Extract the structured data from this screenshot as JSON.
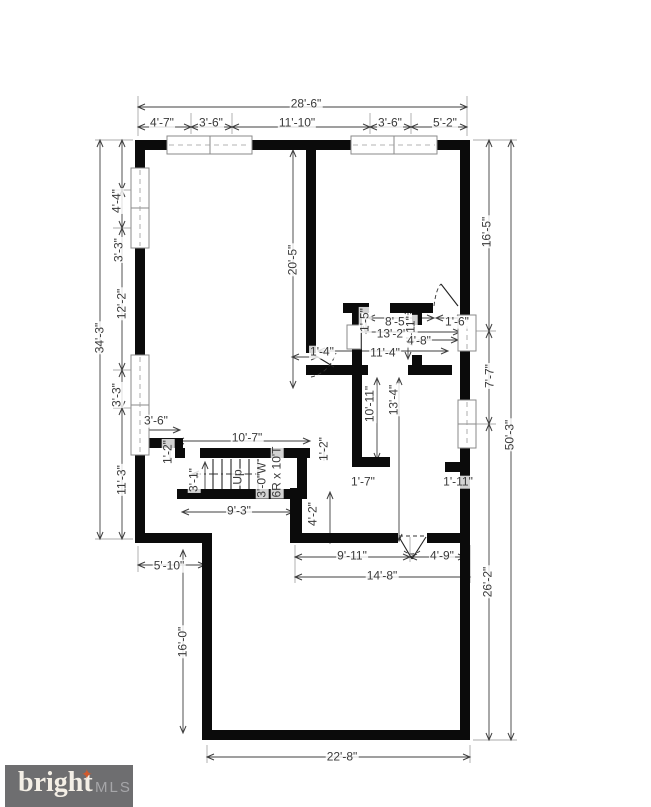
{
  "drawing": {
    "dimension_labels": [
      {
        "text": "28'-6\"",
        "x": 306,
        "y": 104,
        "rot": 0
      },
      {
        "text": "4'-7\"",
        "x": 162,
        "y": 123,
        "rot": 0
      },
      {
        "text": "3'-6\"",
        "x": 211,
        "y": 123,
        "rot": 0
      },
      {
        "text": "11'-10\"",
        "x": 297,
        "y": 123,
        "rot": 0
      },
      {
        "text": "3'-6\"",
        "x": 390,
        "y": 123,
        "rot": 0
      },
      {
        "text": "5'-2\"",
        "x": 445,
        "y": 123,
        "rot": 0
      },
      {
        "text": "4'-4\"",
        "x": 117,
        "y": 201,
        "rot": -90
      },
      {
        "text": "3'-3\"",
        "x": 119,
        "y": 250,
        "rot": -90
      },
      {
        "text": "12'-2\"",
        "x": 122,
        "y": 304,
        "rot": -90
      },
      {
        "text": "34'-3\"",
        "x": 100,
        "y": 338,
        "rot": -90
      },
      {
        "text": "3'-3\"",
        "x": 117,
        "y": 395,
        "rot": -90
      },
      {
        "text": "11'-3\"",
        "x": 122,
        "y": 480,
        "rot": -90
      },
      {
        "text": "16'-5\"",
        "x": 487,
        "y": 232,
        "rot": -90
      },
      {
        "text": "7'-7\"",
        "x": 490,
        "y": 376,
        "rot": -90
      },
      {
        "text": "26'-2\"",
        "x": 488,
        "y": 582,
        "rot": -90
      },
      {
        "text": "50'-3\"",
        "x": 510,
        "y": 435,
        "rot": -90
      },
      {
        "text": "20'-5\"",
        "x": 293,
        "y": 260,
        "rot": -90
      },
      {
        "text": "1'-5\"",
        "x": 365,
        "y": 320,
        "rot": -90
      },
      {
        "text": "8'-5\"",
        "x": 397,
        "y": 322,
        "rot": 0
      },
      {
        "text": "13'-2\"",
        "x": 392,
        "y": 334,
        "rot": 0
      },
      {
        "text": "4'-11\"",
        "x": 411,
        "y": 331,
        "rot": -90
      },
      {
        "text": "4'-8\"",
        "x": 419,
        "y": 341,
        "rot": 0
      },
      {
        "text": "11'-4\"",
        "x": 385,
        "y": 353,
        "rot": 0
      },
      {
        "text": "1'-6\"",
        "x": 457,
        "y": 322,
        "rot": 0
      },
      {
        "text": "1'-4\"",
        "x": 322,
        "y": 352,
        "rot": 0
      },
      {
        "text": "10'-11\"",
        "x": 370,
        "y": 404,
        "rot": -90
      },
      {
        "text": "13'-4\"",
        "x": 394,
        "y": 400,
        "rot": -90
      },
      {
        "text": "1'-7\"",
        "x": 363,
        "y": 482,
        "rot": 0
      },
      {
        "text": "1'-11\"",
        "x": 458,
        "y": 482,
        "rot": 0
      },
      {
        "text": "3'-6\"",
        "x": 156,
        "y": 421,
        "rot": 0
      },
      {
        "text": "1'-2\"",
        "x": 168,
        "y": 452,
        "rot": -90
      },
      {
        "text": "1'-2\"",
        "x": 324,
        "y": 449,
        "rot": -90
      },
      {
        "text": "10'-7\"",
        "x": 247,
        "y": 438,
        "rot": 0
      },
      {
        "text": "3'-1\"",
        "x": 194,
        "y": 480,
        "rot": -90
      },
      {
        "text": "Up",
        "x": 238,
        "y": 477,
        "rot": -90
      },
      {
        "text": "3'-0\"W",
        "x": 262,
        "y": 480,
        "rot": -90
      },
      {
        "text": "6R x 10'T",
        "x": 277,
        "y": 472,
        "rot": -90
      },
      {
        "text": "9'-3\"",
        "x": 239,
        "y": 511,
        "rot": 0
      },
      {
        "text": "4'-2\"",
        "x": 313,
        "y": 514,
        "rot": -90
      },
      {
        "text": "9'-11\"",
        "x": 352,
        "y": 556,
        "rot": 0
      },
      {
        "text": "4'-9\"",
        "x": 442,
        "y": 556,
        "rot": 0
      },
      {
        "text": "14'-8\"",
        "x": 382,
        "y": 576,
        "rot": 0
      },
      {
        "text": "5'-10\"",
        "x": 169,
        "y": 566,
        "rot": 0
      },
      {
        "text": "16'-0\"",
        "x": 183,
        "y": 642,
        "rot": -90
      },
      {
        "text": "22'-8\"",
        "x": 342,
        "y": 757,
        "rot": 0
      }
    ]
  },
  "logo": {
    "brand": "bright",
    "suffix": "MLS",
    "star_glyph": "✦",
    "bar_color": "#6e6e70",
    "star_color": "#cf5a2e"
  }
}
